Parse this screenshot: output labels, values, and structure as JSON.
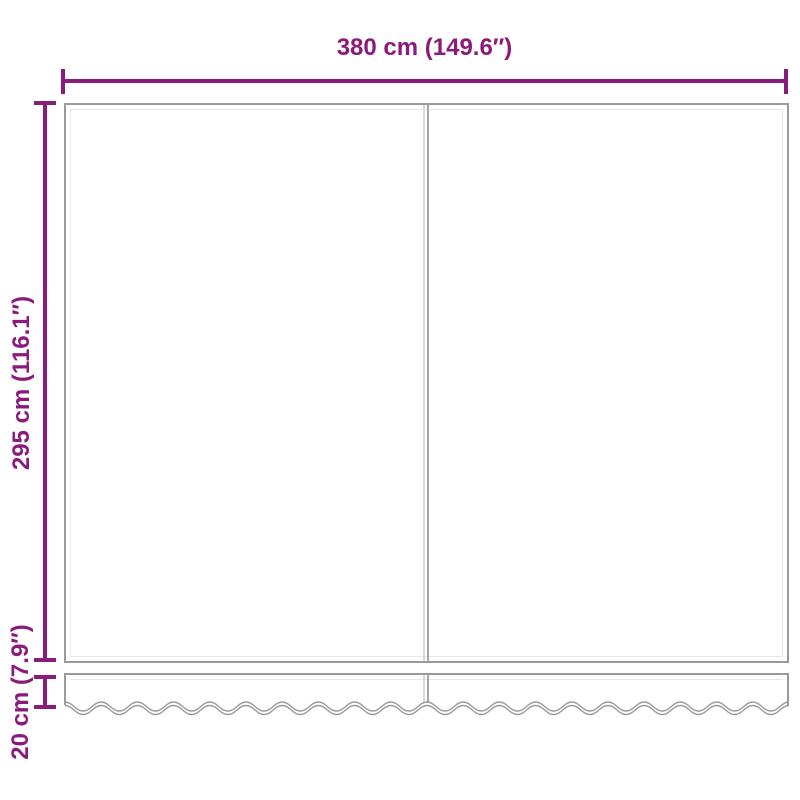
{
  "diagram": {
    "type": "product-dimension-diagram",
    "product": "awning-replacement-fabric-with-valance",
    "dimensions": {
      "width": {
        "label": "380 cm (149.6″)"
      },
      "height": {
        "label": "295 cm (116.1″)"
      },
      "valance": {
        "label": "20 cm (7.9″)"
      }
    },
    "colors": {
      "dimension_accent": "#8a1a7c",
      "outline": "#9a9a9a",
      "outline_highlight": "#e7e7e7",
      "background": "#ffffff"
    }
  }
}
